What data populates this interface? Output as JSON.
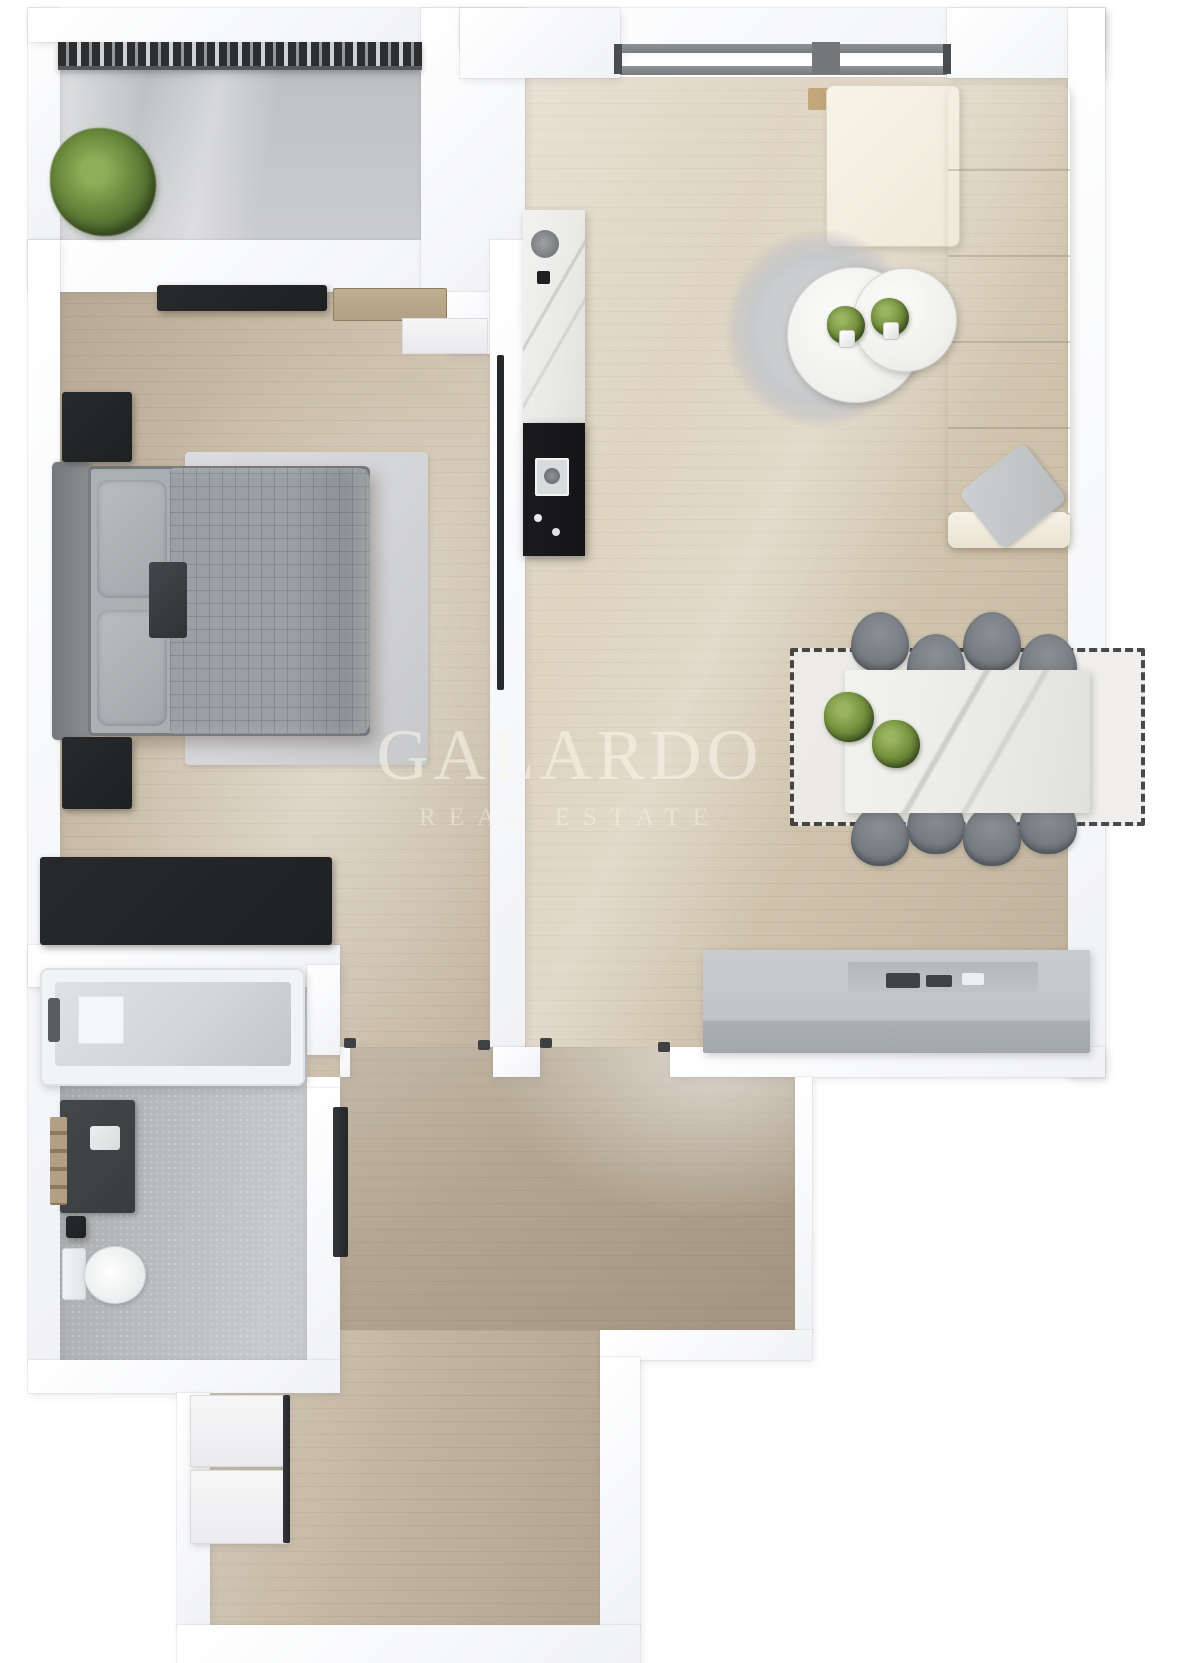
{
  "watermark": {
    "title": "GALARDO",
    "subtitle": "REAL ESTATE"
  },
  "palette": {
    "page_bg": "#ffffff",
    "wall": "#f7f8fa",
    "wood_living": "#d8ccb5",
    "wood_bedroom": "#cdc0aa",
    "wood_hall": "#b3a590",
    "wood_hall_lower": "#c2b49e",
    "balcony_concrete": "#bfc1c3",
    "bath_tile": "#b6b8ba",
    "railing_dark": "#2d2e30",
    "furniture_black": "#1e2022",
    "bed_gray": "#9aa0a4",
    "bed_rug": "#d4d5d7",
    "sofa_cream": "#efe8d9",
    "rug_round_gray": "#c6c8ca",
    "table_marble": "#f5f5f3",
    "chair_gray": "#757b80",
    "counter_black": "#141416",
    "sideboard_gray": "#c0c4c7",
    "fixture_white": "#f2f3f4",
    "tub_gray": "#d3d6d8",
    "vanity_dark": "#3a3c3e",
    "wood_accent_tan": "#b3a084",
    "plant_green": "#78943f",
    "watermark_text": "rgba(249,244,234,0.58)"
  },
  "scene": {
    "type": "3d-floor-plan-render",
    "rooms": [
      {
        "name": "balcony",
        "items": [
          "railing",
          "potted-plant"
        ]
      },
      {
        "name": "bedroom",
        "items": [
          "double-bed",
          "nightstand",
          "nightstand",
          "wardrobe",
          "dresser",
          "area-rug",
          "wall-tv",
          "black-console"
        ]
      },
      {
        "name": "living-room-kitchen",
        "items": [
          "corner-sofa",
          "round-rug",
          "coffee-table",
          "coffee-table",
          "dining-table",
          "dining-rug",
          "kitchen-counter",
          "cooktop",
          "sink",
          "sideboard",
          "window"
        ]
      },
      {
        "name": "bathroom",
        "items": [
          "bathtub",
          "vanity-sink",
          "towel-rack",
          "toilet",
          "bin"
        ]
      },
      {
        "name": "hallway",
        "items": [
          "tall-mirror",
          "closet",
          "closet"
        ]
      }
    ],
    "counts": {
      "dining_chairs": 8,
      "coffee_tables": 2,
      "plants": 5
    }
  }
}
